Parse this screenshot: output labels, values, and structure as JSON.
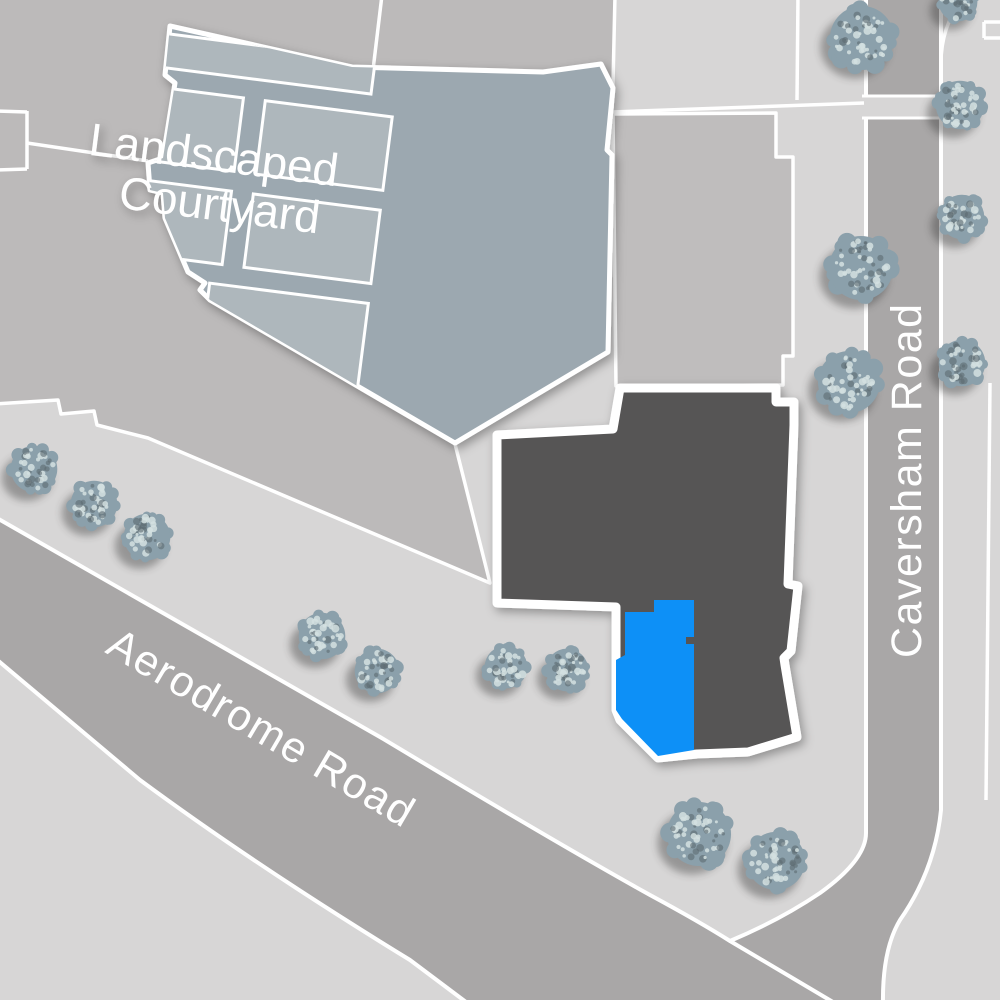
{
  "map": {
    "type": "site-plan",
    "courtyard_label": {
      "line1": "Landscaped",
      "line2": "Courtyard"
    },
    "roads": [
      {
        "name": "Aerodrome Road",
        "orientation": "diagonal"
      },
      {
        "name": "Caversham Road",
        "orientation": "vertical"
      }
    ],
    "highlighted_unit": {
      "name": "selected-plot",
      "color": "#0a90f7"
    },
    "colors": {
      "background": "#bcbaba",
      "sidewalk": "#d7d6d6",
      "road": "#a9a7a7",
      "parcel": "#bfbdbd",
      "courtyard_base": "#9ca8b0",
      "courtyard_panel": "#aeb7bc",
      "building": "#575455",
      "highlight_blue": "#0a90f7",
      "line_white": "#ffffff",
      "tree_base": "#8ba0ab",
      "tree_light": "#d4e0e0",
      "tree_dark": "#5d6a72",
      "tree_shadow": "#2f2f2f"
    },
    "trees": [
      {
        "x": 862,
        "y": 38,
        "r": 33
      },
      {
        "x": 958,
        "y": 2,
        "r": 20
      },
      {
        "x": 960,
        "y": 105,
        "r": 25
      },
      {
        "x": 962,
        "y": 217,
        "r": 23
      },
      {
        "x": 861,
        "y": 268,
        "r": 33
      },
      {
        "x": 849,
        "y": 382,
        "r": 32
      },
      {
        "x": 962,
        "y": 363,
        "r": 24
      },
      {
        "x": 34,
        "y": 469,
        "r": 24
      },
      {
        "x": 94,
        "y": 504,
        "r": 24
      },
      {
        "x": 147,
        "y": 537,
        "r": 24
      },
      {
        "x": 322,
        "y": 636,
        "r": 24
      },
      {
        "x": 377,
        "y": 671,
        "r": 23
      },
      {
        "x": 506,
        "y": 667,
        "r": 22
      },
      {
        "x": 567,
        "y": 670,
        "r": 22
      },
      {
        "x": 699,
        "y": 834,
        "r": 33
      },
      {
        "x": 776,
        "y": 861,
        "r": 30
      }
    ]
  }
}
